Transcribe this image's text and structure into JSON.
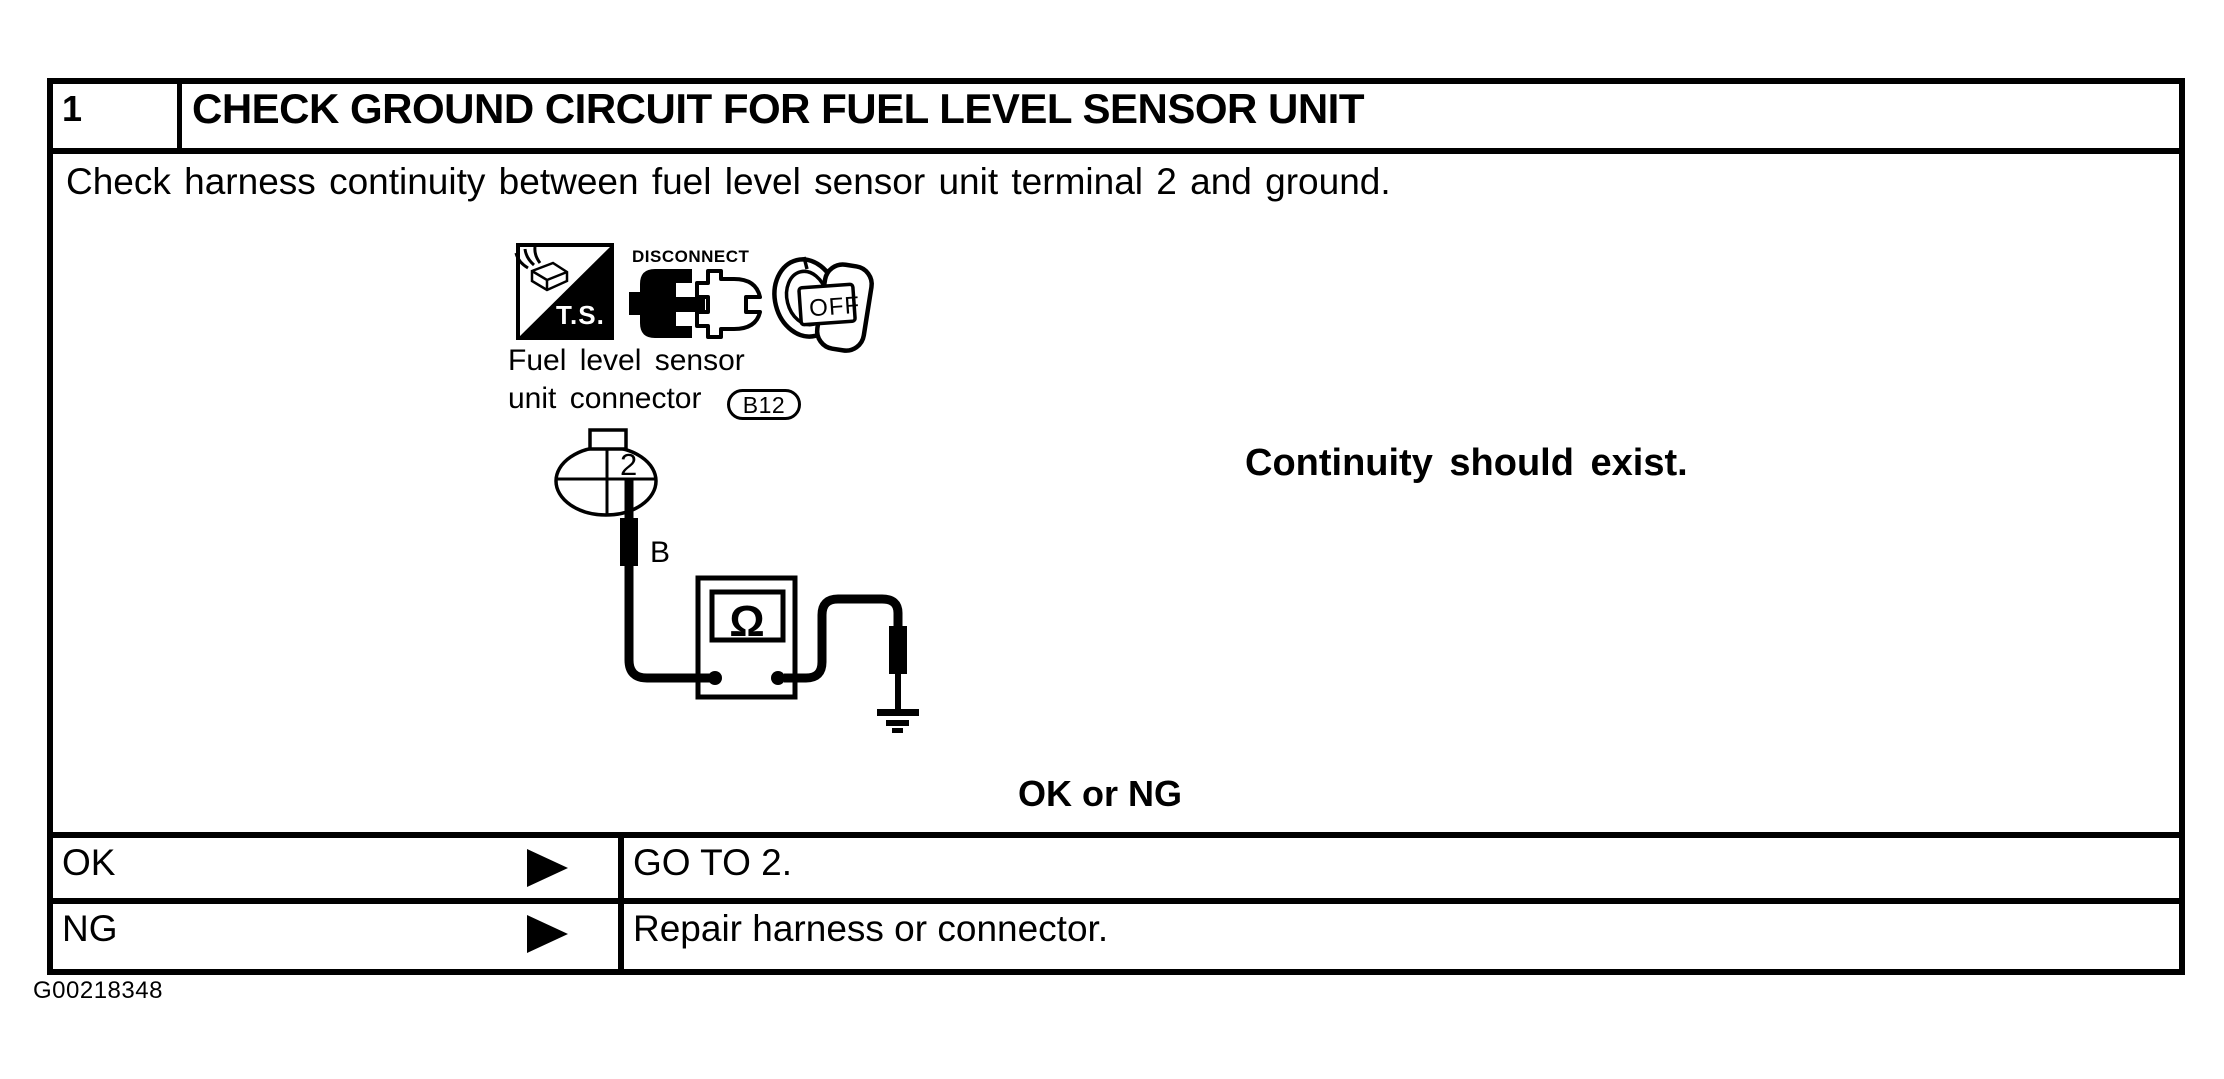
{
  "page": {
    "figure_code": "G00218348"
  },
  "header": {
    "step_number": "1",
    "title": "CHECK GROUND CIRCUIT FOR FUEL LEVEL SENSOR UNIT"
  },
  "body": {
    "instruction": "Check harness continuity between fuel level sensor unit terminal 2 and ground.",
    "expected_result": "Continuity should exist.",
    "decision_label": "OK or NG"
  },
  "diagram": {
    "ts_badge": "T.S.",
    "disconnect_caption": "DISCONNECT",
    "ignition_position": "OFF",
    "connector_caption_line1": "Fuel level sensor",
    "connector_caption_line2": "unit connector",
    "connector_code": "B12",
    "terminal_number": "2",
    "wire_label": "B",
    "meter_symbol": "Ω"
  },
  "outcomes": [
    {
      "condition": "OK",
      "action": "GO TO 2."
    },
    {
      "condition": "NG",
      "action": "Repair harness or connector."
    }
  ]
}
